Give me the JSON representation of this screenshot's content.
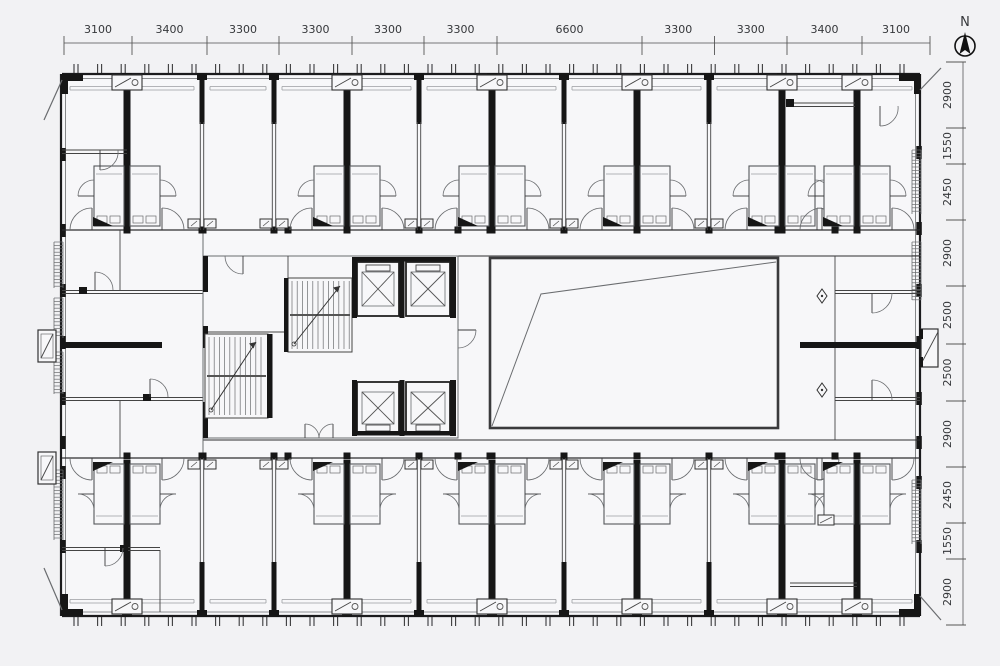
{
  "page": {
    "background": "#f2f2f4"
  },
  "north_arrow": {
    "label": "N",
    "icon": "north-compass-icon"
  },
  "dimensions": {
    "top": {
      "labels": [
        "3100",
        "3400",
        "3300",
        "3300",
        "3300",
        "3300",
        "6600",
        "3300",
        "3300",
        "3400",
        "3100"
      ]
    },
    "right": {
      "labels": [
        "2900",
        "1550",
        "2450",
        "2900",
        "2500",
        "2500",
        "2900",
        "2450",
        "1550",
        "2900"
      ]
    }
  },
  "colors": {
    "background": "#f2f2f4",
    "paper": "#f7f7f9",
    "wall": "#161616",
    "line_dark": "#3a3a3c",
    "line_mid": "#6a6c6f",
    "line_light": "#9b9da0",
    "dim_text": "#35373a"
  }
}
